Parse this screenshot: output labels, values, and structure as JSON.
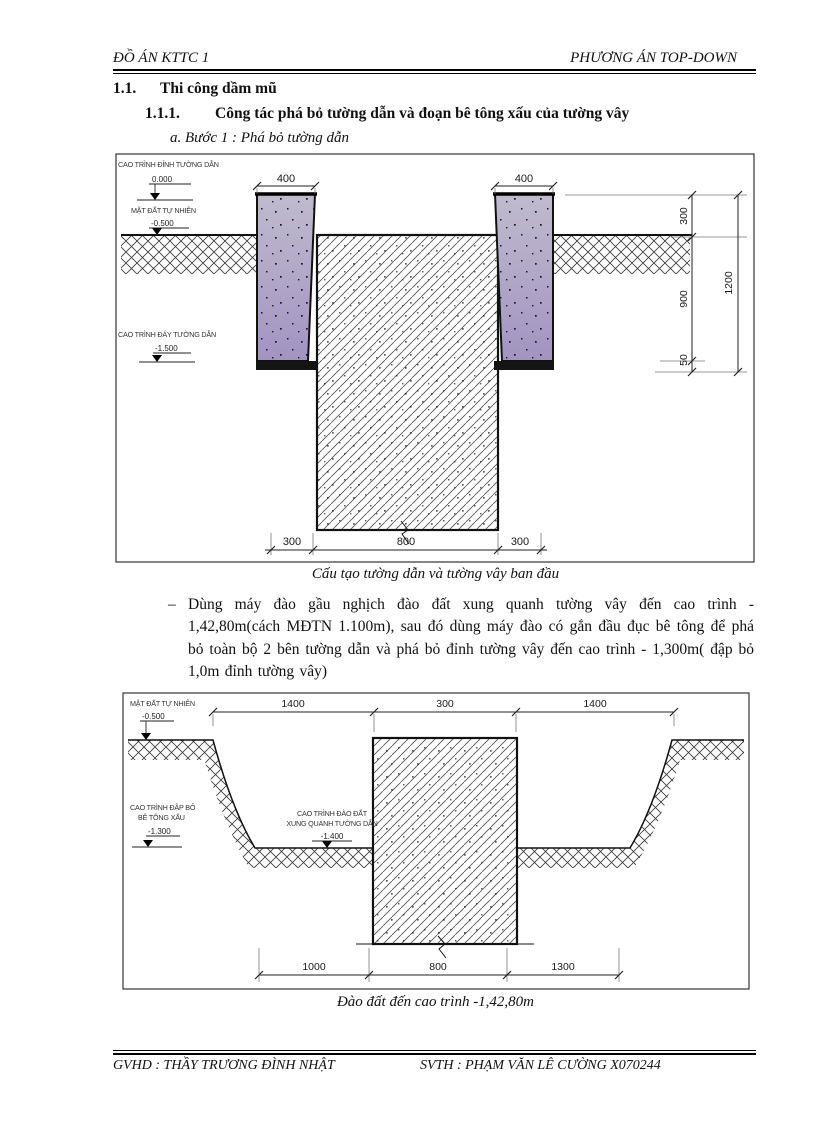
{
  "page": {
    "header_left": "ĐỒ ÁN KTTC 1",
    "header_right": "PHƯƠNG ÁN TOP-DOWN",
    "footer_left": "GVHD : THẦY TRƯƠNG ĐÌNH NHẬT",
    "footer_right": "SVTH : PHẠM VĂN LÊ CƯỜNG X070244"
  },
  "headings": {
    "h1_num": "1.1.",
    "h1_text": "Thi công dầm mũ",
    "h2_num": "1.1.1.",
    "h2_text": "Công tác phá bỏ tường dẫn và đoạn bê tông xấu của tường vây",
    "item_a": "a. Bước 1 : Phá bỏ tường dẫn"
  },
  "paragraph": {
    "bullet": "–",
    "text": "Dùng máy đào gầu nghịch đào đất xung quanh tường vây đến cao trình - 1,42,80m(cách MĐTN 1.100m), sau đó dùng máy đào có gắn đầu đục bê tông để phá bỏ toàn bộ 2 bên tường dẫn và phá bỏ đỉnh tường vây đến cao trình - 1,300m( đập bỏ 1,0m đỉnh tường vây)"
  },
  "figure1": {
    "caption": "Cấu tạo tường dẫn và tường vây ban đầu",
    "labels": {
      "top_wall": "CAO TRÌNH ĐỈNH TƯỜNG DẪN",
      "top_wall_val": "0.000",
      "ground": "MẶT ĐẤT TỰ NHIÊN",
      "ground_val": "-0.500",
      "bottom_wall": "CAO TRÌNH ĐÁY TƯỜNG DẪN",
      "bottom_wall_val": "-1.500"
    },
    "dims": {
      "wall_left": "400",
      "wall_right": "400",
      "v300": "300",
      "v900": "900",
      "v50": "50",
      "v1200": "1200",
      "b300l": "300",
      "b800": "800",
      "b300r": "300"
    }
  },
  "figure2": {
    "caption": "Đào đất đến cao trình -1,42,80m",
    "labels": {
      "ground": "MẶT ĐẤT TỰ NHIÊN",
      "ground_val": "-0.500",
      "demol_line1": "CAO TRÌNH ĐẬP BỎ",
      "demol_line2": "BÊ TÔNG XẤU",
      "demol_val": "-1.300",
      "excav_line1": "CAO TRÌNH ĐÀO ĐẤT",
      "excav_line2": "XUNG QUANH TƯỜNG DẪN",
      "excav_val": "-1.400"
    },
    "dims": {
      "t1400l": "1400",
      "t300": "300",
      "t1400r": "1400",
      "b1000": "1000",
      "b800": "800",
      "b1300": "1300"
    }
  },
  "colors": {
    "guide_wall_top": "#c0bbce",
    "guide_wall_bottom": "#a293c2",
    "line": "#111111"
  }
}
